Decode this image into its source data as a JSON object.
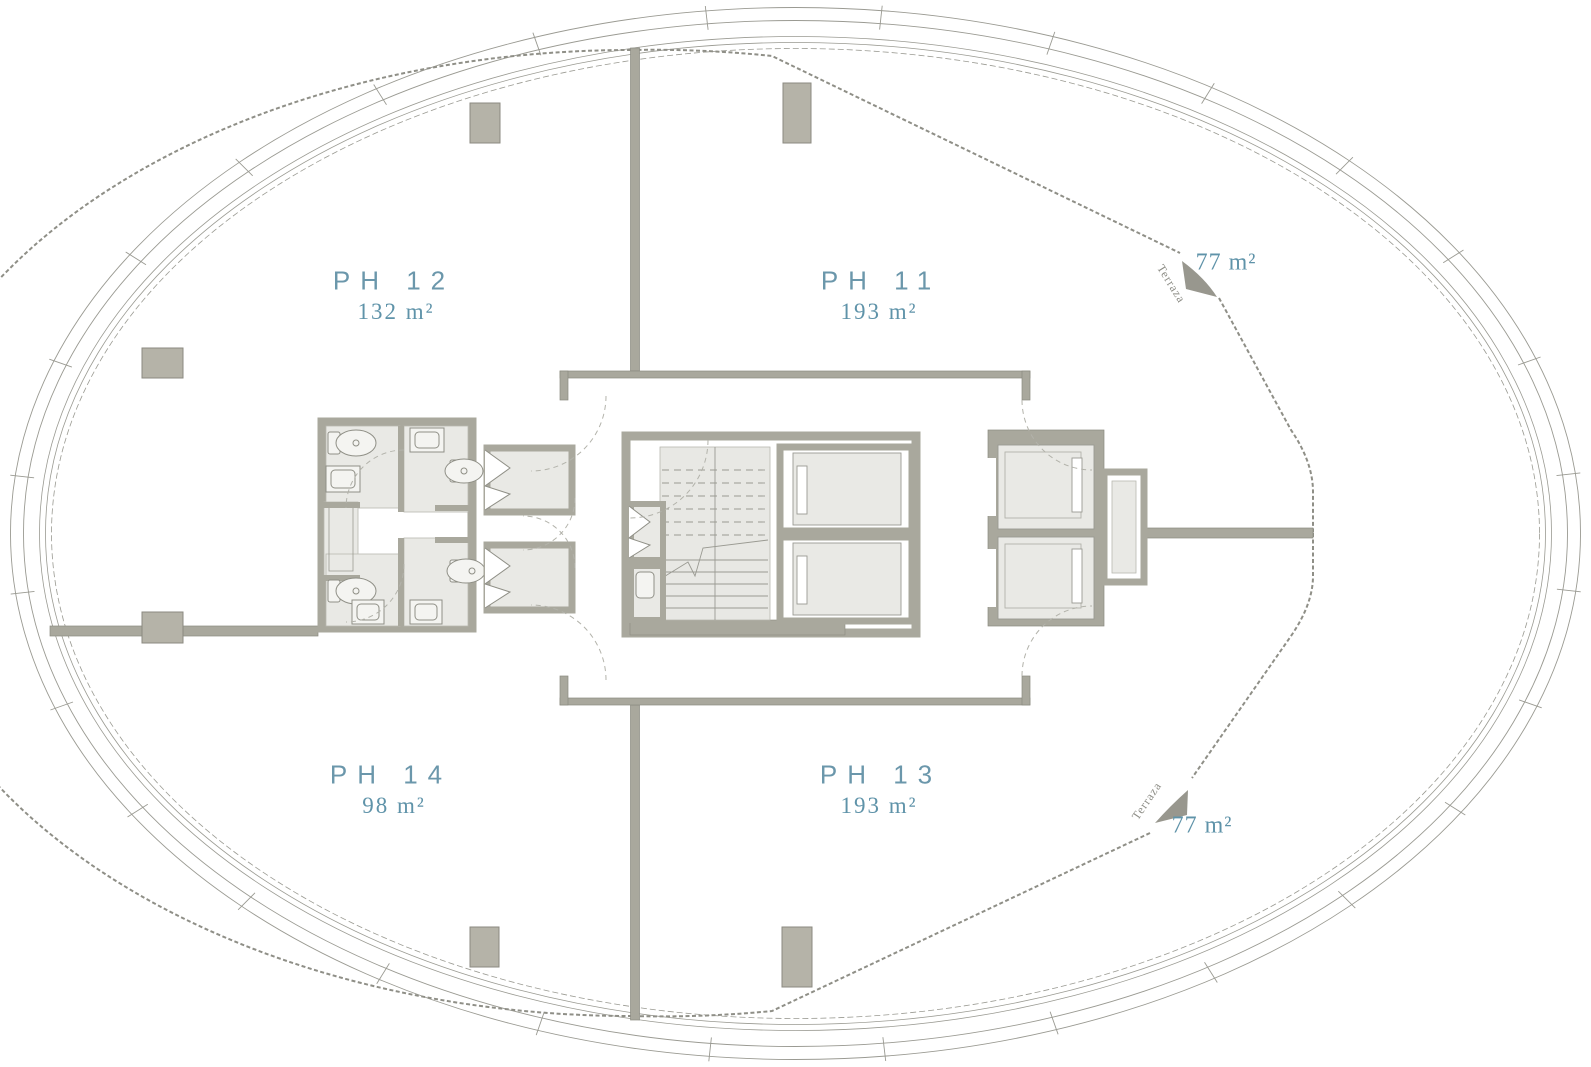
{
  "plan": {
    "title": "Penthouse level floor plan",
    "units": [
      {
        "id": "ph12",
        "name": "PH 12",
        "area": "132 m²"
      },
      {
        "id": "ph11",
        "name": "PH 11",
        "area": "193 m²"
      },
      {
        "id": "ph14",
        "name": "PH 14",
        "area": "98 m²"
      },
      {
        "id": "ph13",
        "name": "PH 13",
        "area": "193 m²"
      }
    ],
    "terraces": [
      {
        "id": "terraza-top",
        "label": "Terraza",
        "area": "77 m²"
      },
      {
        "id": "terraza-bottom",
        "label": "Terraza",
        "area": "77 m²"
      }
    ],
    "colors": {
      "unit_label": "#6b97ab",
      "area_label": "#5f93a9",
      "terrace_label": "#8d8d86",
      "wall": "#a9a89d",
      "wall_edge": "#8b8a80",
      "column": "#b5b3a8",
      "room_fill": "#e9e9e5",
      "thin_line": "#9a9a92",
      "railing": "#8f8f87",
      "arrow": "#98978e"
    }
  }
}
